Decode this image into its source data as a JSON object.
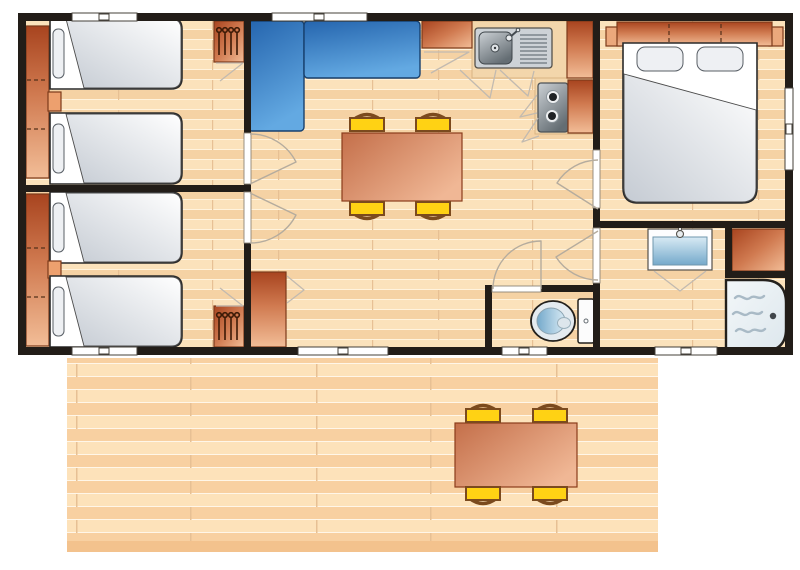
{
  "canvas": {
    "width": 800,
    "height": 565
  },
  "colors": {
    "wall": "#221d18",
    "floor-light": "#fbe2bb",
    "floor-mid": "#f5d2a4",
    "floor-seam": "#fff3dd",
    "floor-joint": "#e7c094",
    "deck-light": "#fde2ba",
    "deck-mid": "#f8d0a1",
    "deck-seam": "#fff6e8",
    "deck-edge": "#f3c28d",
    "wood-dark": "#a8441f",
    "wood-mid": "#d07a50",
    "wood-light": "#f2bd97",
    "wood-outline": "#7c3a1a",
    "counter-beige": "#f3d6ab",
    "counter-edge": "#d9b483",
    "sofa-dark": "#2565ae",
    "sofa-light": "#63a9e2",
    "table-dark": "#c46f4a",
    "table-light": "#f0b795",
    "chair-yellow": "#ffd214",
    "chair-brown": "#7b4a1e",
    "bed-white": "#ffffff",
    "blanket-gray": "#c5cbd3",
    "bed-outline": "#2a2a2a",
    "metal-light": "#ccd1d5",
    "metal-dark": "#646d73",
    "water-light": "#d8eaf4",
    "water-mid": "#74a9cb",
    "wave-gray": "#a9bac6",
    "shower-light": "#f3f7f9",
    "shower-mid": "#dde7ed",
    "line-gray": "#c2bab0"
  },
  "plan": {
    "type": "mobile-home-floorplan-top-view",
    "rooms": [
      {
        "name": "twin-bedroom-top",
        "furniture": [
          "wardrobe-strip",
          "single-bed",
          "nightstand",
          "single-bed",
          "hanging-closet"
        ],
        "windows": 1,
        "doors": 1
      },
      {
        "name": "twin-bedroom-bottom",
        "furniture": [
          "wardrobe-strip",
          "single-bed",
          "nightstand",
          "single-bed",
          "hanging-closet"
        ],
        "windows": 1,
        "doors": 1
      },
      {
        "name": "living-room",
        "furniture": [
          "l-shaped-sofa",
          "dining-table",
          "chair",
          "chair",
          "chair",
          "chair",
          "storage-cabinet"
        ],
        "windows": 1,
        "patio_doors": 1
      },
      {
        "name": "kitchen",
        "furniture": [
          "fridge-cabinet",
          "sink-with-drainboard",
          "worktop",
          "hob-2-burner",
          "tall-cabinet",
          "base-cabinet"
        ],
        "windows": 0
      },
      {
        "name": "master-bedroom",
        "furniture": [
          "headboard-wardrobe",
          "bedside-table",
          "bedside-table",
          "double-bed"
        ],
        "windows": 1,
        "doors": 1
      },
      {
        "name": "bathroom",
        "furniture": [
          "washbasin-vanity",
          "storage-cabinet",
          "shower-tray"
        ],
        "windows": 1,
        "doors": 1
      },
      {
        "name": "wc",
        "furniture": [
          "toilet-with-cistern"
        ],
        "windows": 1,
        "doors": 1
      }
    ],
    "deck": {
      "name": "wooden-terrace",
      "furniture": [
        "dining-table",
        "chair",
        "chair",
        "chair",
        "chair"
      ]
    },
    "counts": {
      "single_beds": 4,
      "double_beds": 1,
      "indoor_chairs": 4,
      "deck_chairs": 4,
      "windows": 6,
      "exterior_doors": 1
    }
  }
}
